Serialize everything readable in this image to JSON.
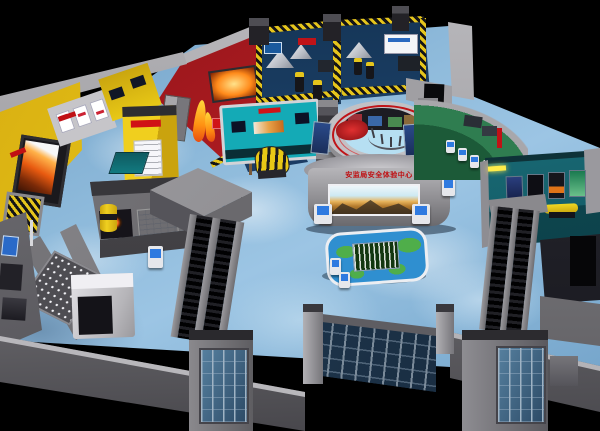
{
  "scene": {
    "description": "Isometric 3D render of a safety-education exhibition hall interior at night",
    "led_wall": {
      "banner_text": "安监局安全体验中心"
    },
    "colors": {
      "background": "#000000",
      "floor_blue": "#9cc5e4",
      "wall_grey": "#8e8d91",
      "hazard_yellow": "#e5c51c",
      "zone_red": "#b01c22",
      "zone_yellow": "#e8c816",
      "zone_cyan": "#14aab6",
      "zone_green": "#2f7d50",
      "zone_teal_room": "#145a64",
      "room_blue_wall": "#1c4067",
      "banner_red": "#c00d10",
      "screen_sky": "#cde9f2",
      "screen_gold": "#b67c2e",
      "fire_orange": "#e85a10",
      "glass_blue": "#2c4a66",
      "map_water": "#2f8fd0",
      "map_land": "#4fae4a"
    }
  }
}
